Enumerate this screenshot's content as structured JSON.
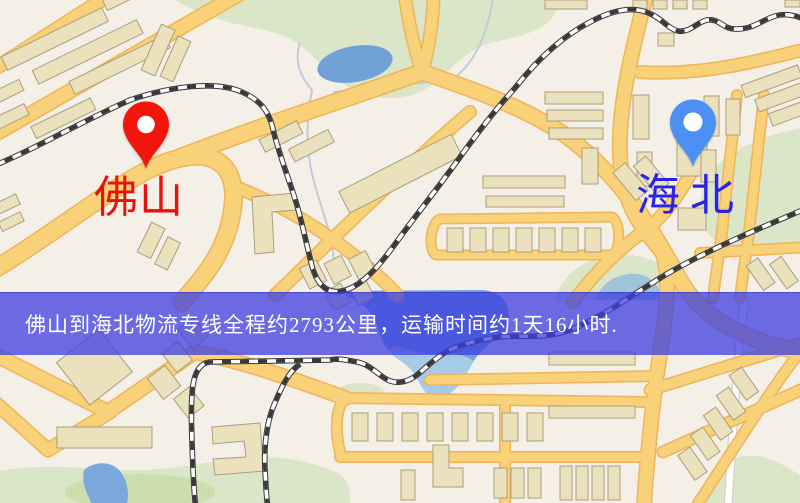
{
  "banner": {
    "text": "佛山到海北物流专线全程约2793公里，运输时间约1天16小时.",
    "background": "rgba(62,61,226,0.75)",
    "text_color": "#ffffff"
  },
  "markers": {
    "origin": {
      "label": "佛山",
      "pin_color": "#f1150b",
      "label_color": "#e8120a",
      "icon": "red-location-pin-icon"
    },
    "destination": {
      "label": "海北",
      "pin_color": "#4b90f2",
      "label_color": "#2a22e8",
      "icon": "blue-location-pin-icon"
    }
  },
  "route": {
    "origin": "佛山",
    "destination": "海北",
    "distance_text": "约2793公里",
    "duration_text": "约1天16小时"
  },
  "map_palette": {
    "background": "#f4efe7",
    "road_fill": "#f8d178",
    "road_casing": "#eeb55a",
    "building": "#ebe1bd",
    "park": "#dbe6c9",
    "water": "#72a2d8",
    "railway": "#383838"
  }
}
